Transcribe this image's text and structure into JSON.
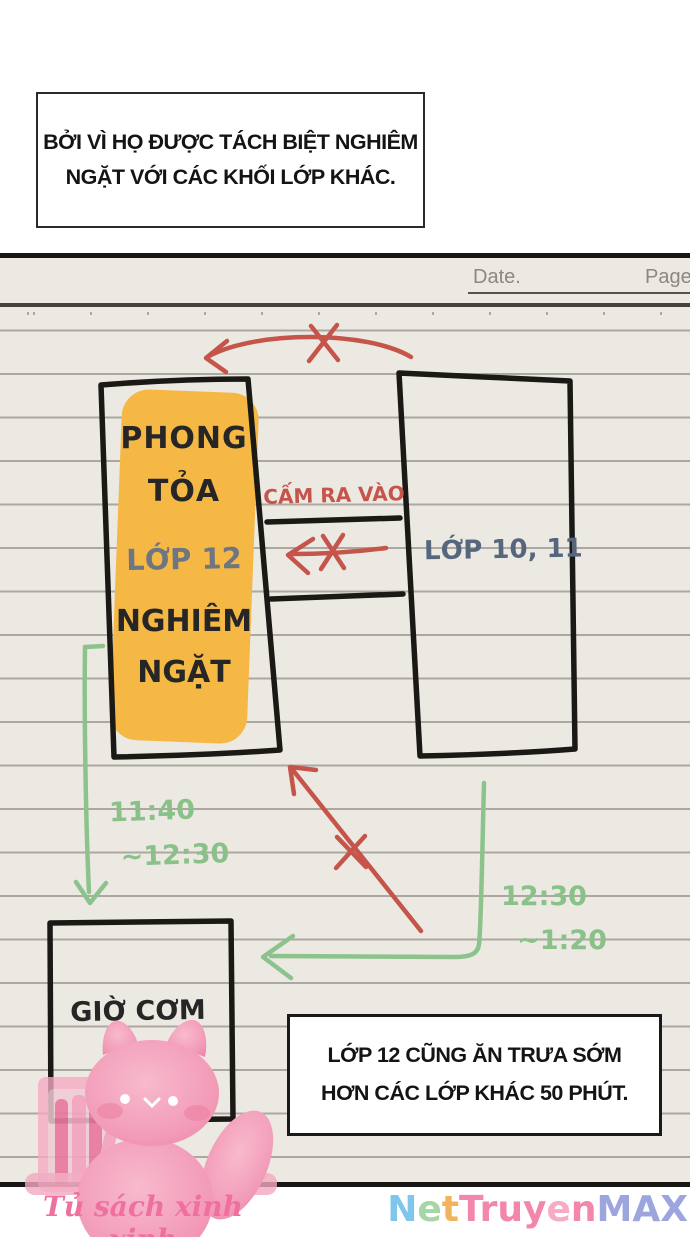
{
  "top_caption": {
    "line1": "BỞI VÌ HỌ ĐƯỢC TÁCH BIỆT NGHIÊM",
    "line2": "NGẶT VỚI CÁC KHỐI LỚP KHÁC."
  },
  "notebook_header": {
    "date_label": "Date.",
    "page_label": "Page."
  },
  "diagram": {
    "lockdown_box": {
      "line1": "PHONG",
      "line2": "TỎA",
      "line3": "LỚP 12",
      "line4": "NGHIÊM",
      "line5": "NGẶT"
    },
    "no_entry_label": "CẤM RA VÀO",
    "other_grades_box_label": "LỚP 10, 11",
    "lunch_box_label": "GIỜ CƠM",
    "lunch_time_grade12": {
      "line1": "11:40",
      "line2": "~12:30"
    },
    "lunch_time_others": {
      "line1": "12:30",
      "line2": "~1:20"
    }
  },
  "bottom_caption": {
    "line1": "LỚP 12 CŨNG ĂN TRƯA SỚM",
    "line2": "HƠN CÁC LỚP KHÁC 50 PHÚT."
  },
  "footer": {
    "publisher": "Tủ sách xinh xinh",
    "watermark_letters": [
      {
        "ch": "N",
        "color": "#7EC6EA"
      },
      {
        "ch": "e",
        "color": "#A6D6A6"
      },
      {
        "ch": "t",
        "color": "#F2B45A"
      },
      {
        "ch": "T",
        "color": "#F286AC"
      },
      {
        "ch": "r",
        "color": "#F286AC"
      },
      {
        "ch": "u",
        "color": "#F286AC"
      },
      {
        "ch": "y",
        "color": "#F286AC"
      },
      {
        "ch": "e",
        "color": "#F6ACC6"
      },
      {
        "ch": "n",
        "color": "#F286AC"
      },
      {
        "ch": "M",
        "color": "#9DA5DE"
      },
      {
        "ch": "A",
        "color": "#9DA5DE"
      },
      {
        "ch": "X",
        "color": "#9DA5DE"
      }
    ]
  },
  "colors": {
    "paper": "#ECE9E2",
    "highlight_orange": "#F6B845",
    "forbidden_red": "#C5544A",
    "time_green": "#8CC38C",
    "label_blue_gray": "#56677D",
    "mascot_pink": "#F29BB8"
  }
}
